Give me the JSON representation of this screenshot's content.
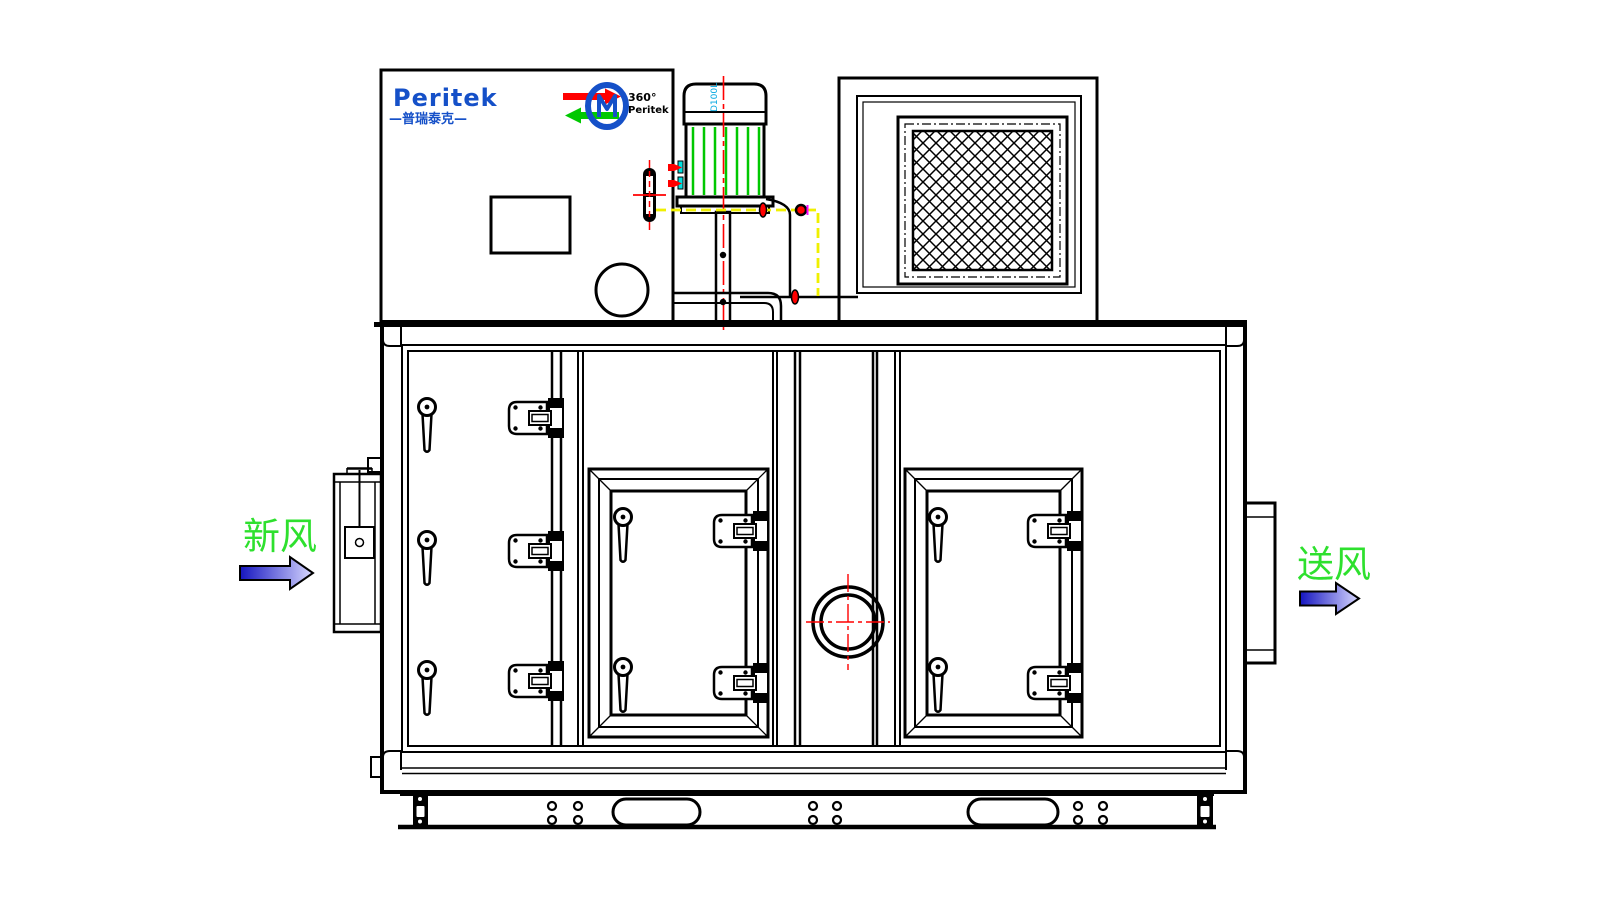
{
  "labels": {
    "brand": "Peritek",
    "brand_cn": "—普瑞泰克—",
    "rotor_degree": "360°",
    "rotor_brand": "Peritek",
    "motor_mark": "D100L",
    "inlet": "新风",
    "outlet": "送风"
  },
  "colors": {
    "line_black": "#000000",
    "brand_blue": "#1550c8",
    "centerline_red": "#ff0000",
    "pipe_yellow": "#f0f000",
    "fin_green": "#00c800",
    "label_green": "#2ee02e",
    "mark_cyan": "#00a6e0",
    "cyan_strip": "#00e0e0",
    "magenta": "#ff00ff",
    "arrow_gradient_start": "#1515c0",
    "arrow_gradient_end": "#d8d8ff"
  }
}
